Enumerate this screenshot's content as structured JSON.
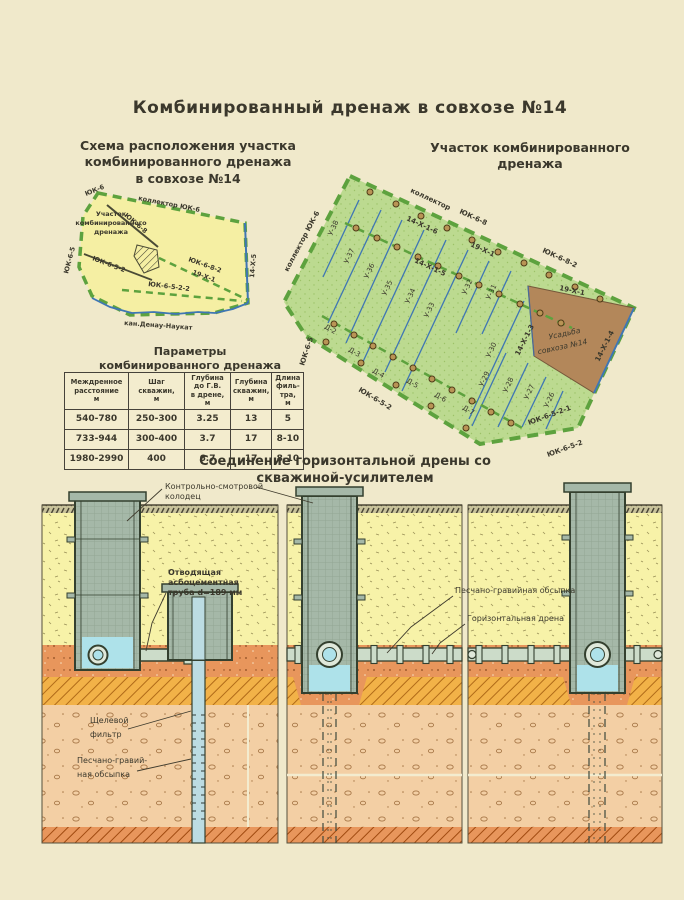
{
  "page": {
    "title": "Комбинированный дренаж в совхозе №14"
  },
  "schematic_map": {
    "t1": "Схема расположения участка",
    "t2": "комбинированного дренажа",
    "t3": "в совхозе №14",
    "uk6": "ЮК-6",
    "collector": "коллектор ЮК-6",
    "uk68": "ЮК-6-8",
    "plot1": "Участок",
    "plot2": "комбинированного",
    "plot3": "дренажа",
    "uk65": "ЮК-6-5",
    "uk652": "ЮК-6-5-2",
    "uk682": "ЮК-6-8-2",
    "x191": "19-Х-1",
    "uk6522": "ЮК-6-5-2-2",
    "x145": "14-Х-5",
    "canal": "кан.Денау-Наукат"
  },
  "site_map": {
    "t1": "Участок комбинированного",
    "t2": "дренажа",
    "collector_left": "коллектор ЮК-6",
    "collector_top": "коллектор",
    "uk68": "ЮК-6-8",
    "uk682": "ЮК-6-8-2",
    "x191_top": "19-Х-1",
    "x1416": "14-Х-1-6",
    "x1415": "14-Х-1-5",
    "x191_estate": "19-Х-1",
    "x1413": "14-Х-1-3",
    "x1414": "14-Х-1-4",
    "uk6521": "ЮК-6-5-2-1",
    "uk652_a": "ЮК-6-5-2",
    "uk652_b": "ЮК-6-5-2",
    "uk65": "ЮК-6-5",
    "estate1": "Усадьба",
    "estate2": "совхоза №14",
    "drains": [
      "У-38",
      "У-37",
      "У-36",
      "У-35",
      "У-34",
      "У-33",
      "У-32",
      "У-31",
      "У-30",
      "У-29",
      "У-28",
      "У-27",
      "У-26"
    ],
    "d_drains": [
      "Д-2",
      "Д-3",
      "Д-4",
      "Д-5",
      "Д-6",
      "Д-7"
    ]
  },
  "table": {
    "t1": "Параметры",
    "t2": "комбинированного дренажа",
    "headers": [
      [
        "Междренное",
        "расстояние",
        "м"
      ],
      [
        "Шаг",
        "скважин,",
        "м"
      ],
      [
        "Глубина",
        "до Г.В.",
        "в дрене,",
        "м"
      ],
      [
        "Глубина",
        "скважин,",
        "м"
      ],
      [
        "Длина",
        "филь-",
        "тра,",
        "м"
      ]
    ],
    "rows": [
      [
        "540-780",
        "250-300",
        "3.25",
        "13",
        "5"
      ],
      [
        "733-944",
        "300-400",
        "3.7",
        "17",
        "8-10"
      ],
      [
        "1980-2990",
        "400",
        "6.7",
        "17",
        "8-10"
      ]
    ]
  },
  "section": {
    "t1": "Соединение горизонтальной дрены со",
    "t2": "скважиной-усилителем",
    "ks1": "Контрольно-смотровой",
    "ks2": "колодец",
    "pipe1": "Отводящая",
    "pipe2": "асбоцементная",
    "pipe3": "труба d=189 мм",
    "filter1": "Щелевой",
    "filter2": "фильтр",
    "backfill1": "Песчано-гравий-",
    "backfill2": "ная обсыпка",
    "backfill_full": "Песчано-гравийная обсыпка",
    "hdrain": "Горизонтальная дрена"
  }
}
